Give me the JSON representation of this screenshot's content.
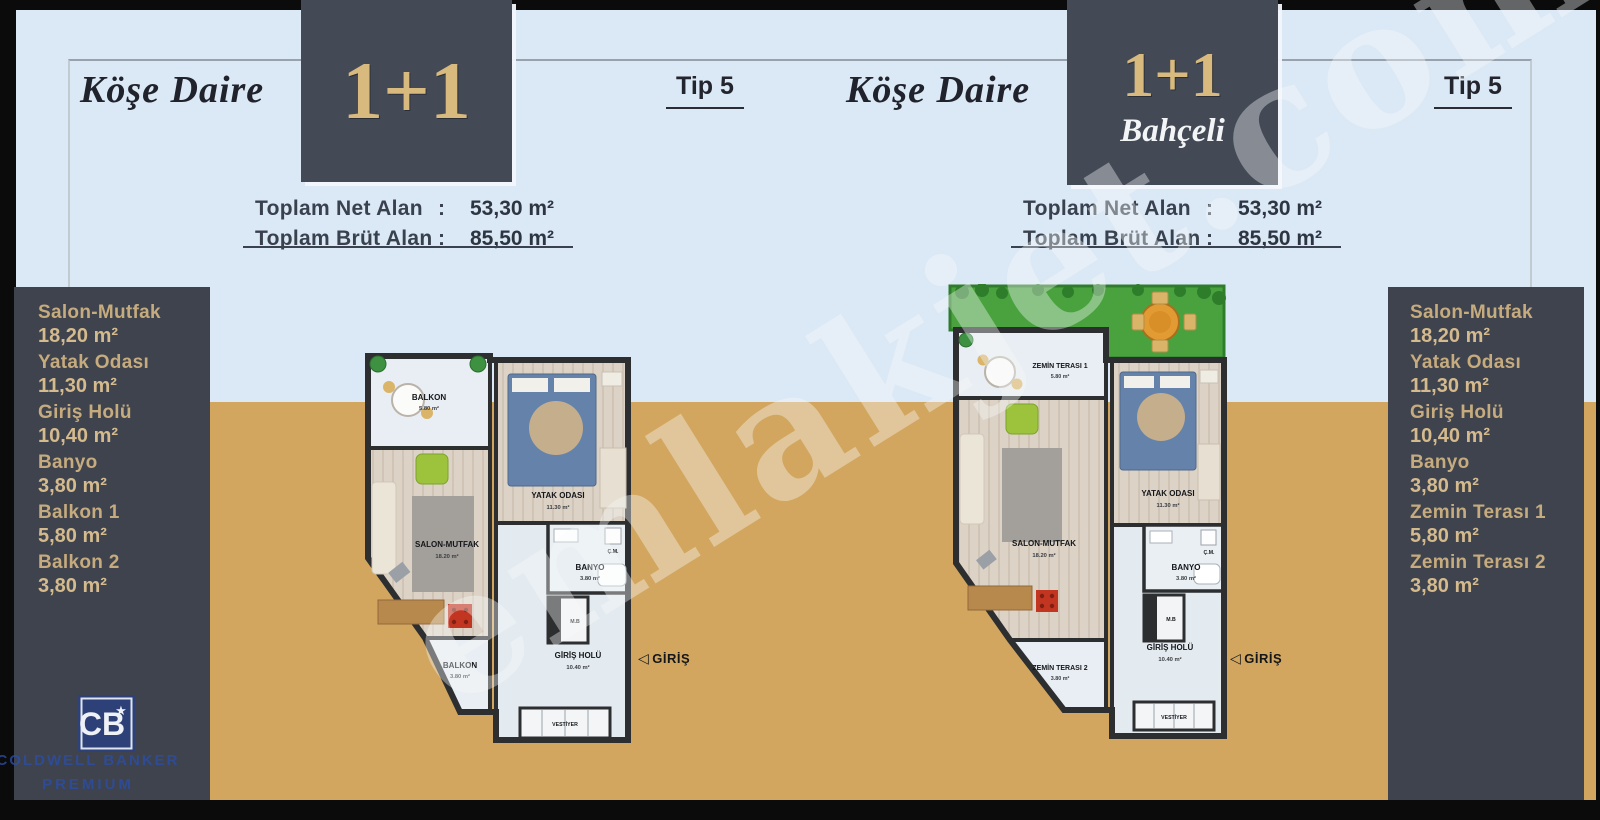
{
  "watermark": {
    "text": "emlakjet.com"
  },
  "header": {
    "left": {
      "title": "Köşe Daire",
      "badge": "1+1",
      "tip": "Tip 5",
      "net_label": "Toplam Net Alan",
      "net_sep": ":",
      "net_value": "53,30 m²",
      "brut_label": "Toplam Brüt Alan",
      "brut_sep": ":",
      "brut_value": "85,50 m²"
    },
    "right": {
      "title": "Köşe Daire",
      "badge": "1+1",
      "badge_sub": "Bahçeli",
      "tip": "Tip 5",
      "net_label": "Toplam Net Alan",
      "net_sep": ":",
      "net_value": "53,30 m²",
      "brut_label": "Toplam Brüt Alan",
      "brut_sep": ":",
      "brut_value": "85,50 m²"
    }
  },
  "sidebar_left": {
    "items": [
      {
        "label": "Salon-Mutfak",
        "value": "18,20 m²"
      },
      {
        "label": "Yatak Odası",
        "value": "11,30 m²"
      },
      {
        "label": "Giriş Holü",
        "value": "10,40 m²"
      },
      {
        "label": "Banyo",
        "value": "3,80 m²"
      },
      {
        "label": "Balkon 1",
        "value": "5,80 m²"
      },
      {
        "label": "Balkon 2",
        "value": "3,80 m²"
      }
    ]
  },
  "sidebar_right": {
    "items": [
      {
        "label": "Salon-Mutfak",
        "value": "18,20 m²"
      },
      {
        "label": "Yatak Odası",
        "value": "11,30 m²"
      },
      {
        "label": "Giriş Holü",
        "value": "10,40 m²"
      },
      {
        "label": "Banyo",
        "value": "3,80 m²"
      },
      {
        "label": "Zemin Terası 1",
        "value": "5,80 m²"
      },
      {
        "label": "Zemin Terası 2",
        "value": "3,80 m²"
      }
    ]
  },
  "plans": {
    "left": {
      "top_room": {
        "label": "BALKON",
        "area": "5.80 m²"
      },
      "bedroom": {
        "label": "YATAK ODASI",
        "area": "11.30 m²"
      },
      "living": {
        "label": "SALON-MUTFAK",
        "area": "18.20 m²"
      },
      "bath": {
        "label": "BANYO",
        "area": "3.80 m²"
      },
      "hall": {
        "label": "GİRİŞ HOLÜ",
        "area": "10.40 m²"
      },
      "closet": "VESTİYER",
      "washer": "Ç.M.",
      "mb": "M.B",
      "bottom_room": {
        "label": "BALKON",
        "area": "3.80 m²"
      },
      "entrance": "GİRİŞ"
    },
    "right": {
      "top_room": {
        "label": "ZEMİN TERASI 1",
        "area": "5.80 m²"
      },
      "bedroom": {
        "label": "YATAK ODASI",
        "area": "11.30 m²"
      },
      "living": {
        "label": "SALON-MUTFAK",
        "area": "18.20 m²"
      },
      "bath": {
        "label": "BANYO",
        "area": "3.80 m²"
      },
      "hall": {
        "label": "GİRİŞ HOLÜ",
        "area": "10.40 m²"
      },
      "closet": "VESTİYER",
      "washer": "Ç.M.",
      "mb": "M.B",
      "bottom_room": {
        "label": "ZEMİN TERASI 2",
        "area": "3.80 m²"
      },
      "entrance": "GİRİŞ"
    }
  },
  "brand": {
    "monogram": "CB",
    "star": "★",
    "line1": "COLDWELL BANKER",
    "line2": "PREMIUM"
  },
  "colors": {
    "background_blue": "#dbe8f5",
    "background_tan": "#d2a65f",
    "panel_dark": "#3e434d",
    "badge_dark": "#434a56",
    "accent_gold": "#d9ba7e",
    "sidebar_gold": "#d4ba8d",
    "text_dark": "#22242e",
    "garden_green": "#4aa23f",
    "brand_blue": "#2b4da6",
    "wall": "#2d2e30"
  }
}
